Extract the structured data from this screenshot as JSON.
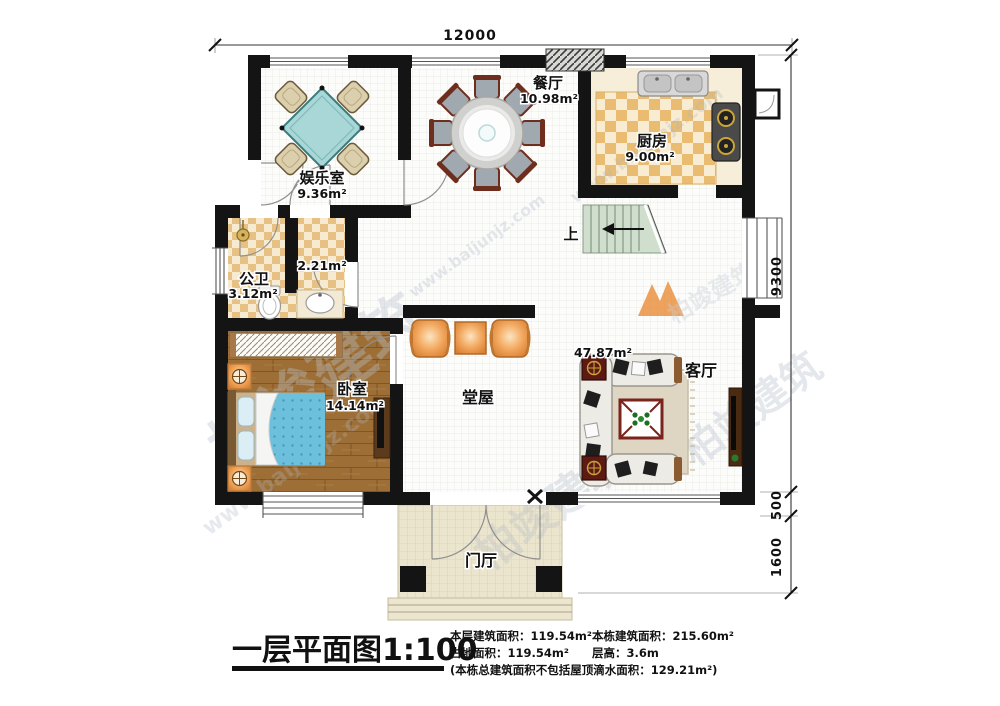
{
  "watermark": {
    "site": "www.baijunjz.com",
    "brand": "柏竣建筑"
  },
  "colors": {
    "wall": "#141414",
    "kitchen_checker": "#e9bc72",
    "bath_checker": "#e6c183",
    "wood_floor": "#9d6e35",
    "table_teal": "#a9d6d6",
    "stairs_green": "#cfdecd",
    "furniture_orange": "#f0a55c",
    "bed_blanket": "#6cc0dc",
    "accent_red": "#7a241c"
  },
  "dimensions": {
    "top_width": "12000",
    "right_main": "9300",
    "right_step": "500",
    "right_porch": "1600"
  },
  "rooms": {
    "entertainment": {
      "name": "娱乐室",
      "area": "9.36m²"
    },
    "dining": {
      "name": "餐厅",
      "area": "10.98m²"
    },
    "kitchen": {
      "name": "厨房",
      "area": "9.00m²"
    },
    "bathroom": {
      "name": "公卫",
      "area": "3.12m²"
    },
    "washroom": {
      "area": "2.21m²"
    },
    "bedroom": {
      "name": "卧室",
      "area": "14.14m²"
    },
    "hall": {
      "name": "堂屋"
    },
    "living": {
      "name": "客厅",
      "area": "47.87m²"
    },
    "foyer": {
      "name": "门厅"
    },
    "stairs": {
      "up_label": "上"
    }
  },
  "title": {
    "text": "一层平面图",
    "scale": "1:100"
  },
  "stats": {
    "floor_area_label": "本层建筑面积：",
    "floor_area_value": "119.54m²",
    "land_area_label": "占地面积：",
    "land_area_value": "119.54m²",
    "building_area_label": "本栋建筑面积：",
    "building_area_value": "215.60m²",
    "floor_height_label": "层高：",
    "floor_height_value": "3.6m",
    "note": "(本栋总建筑面积不包括屋顶滴水面积：129.21m²)"
  }
}
